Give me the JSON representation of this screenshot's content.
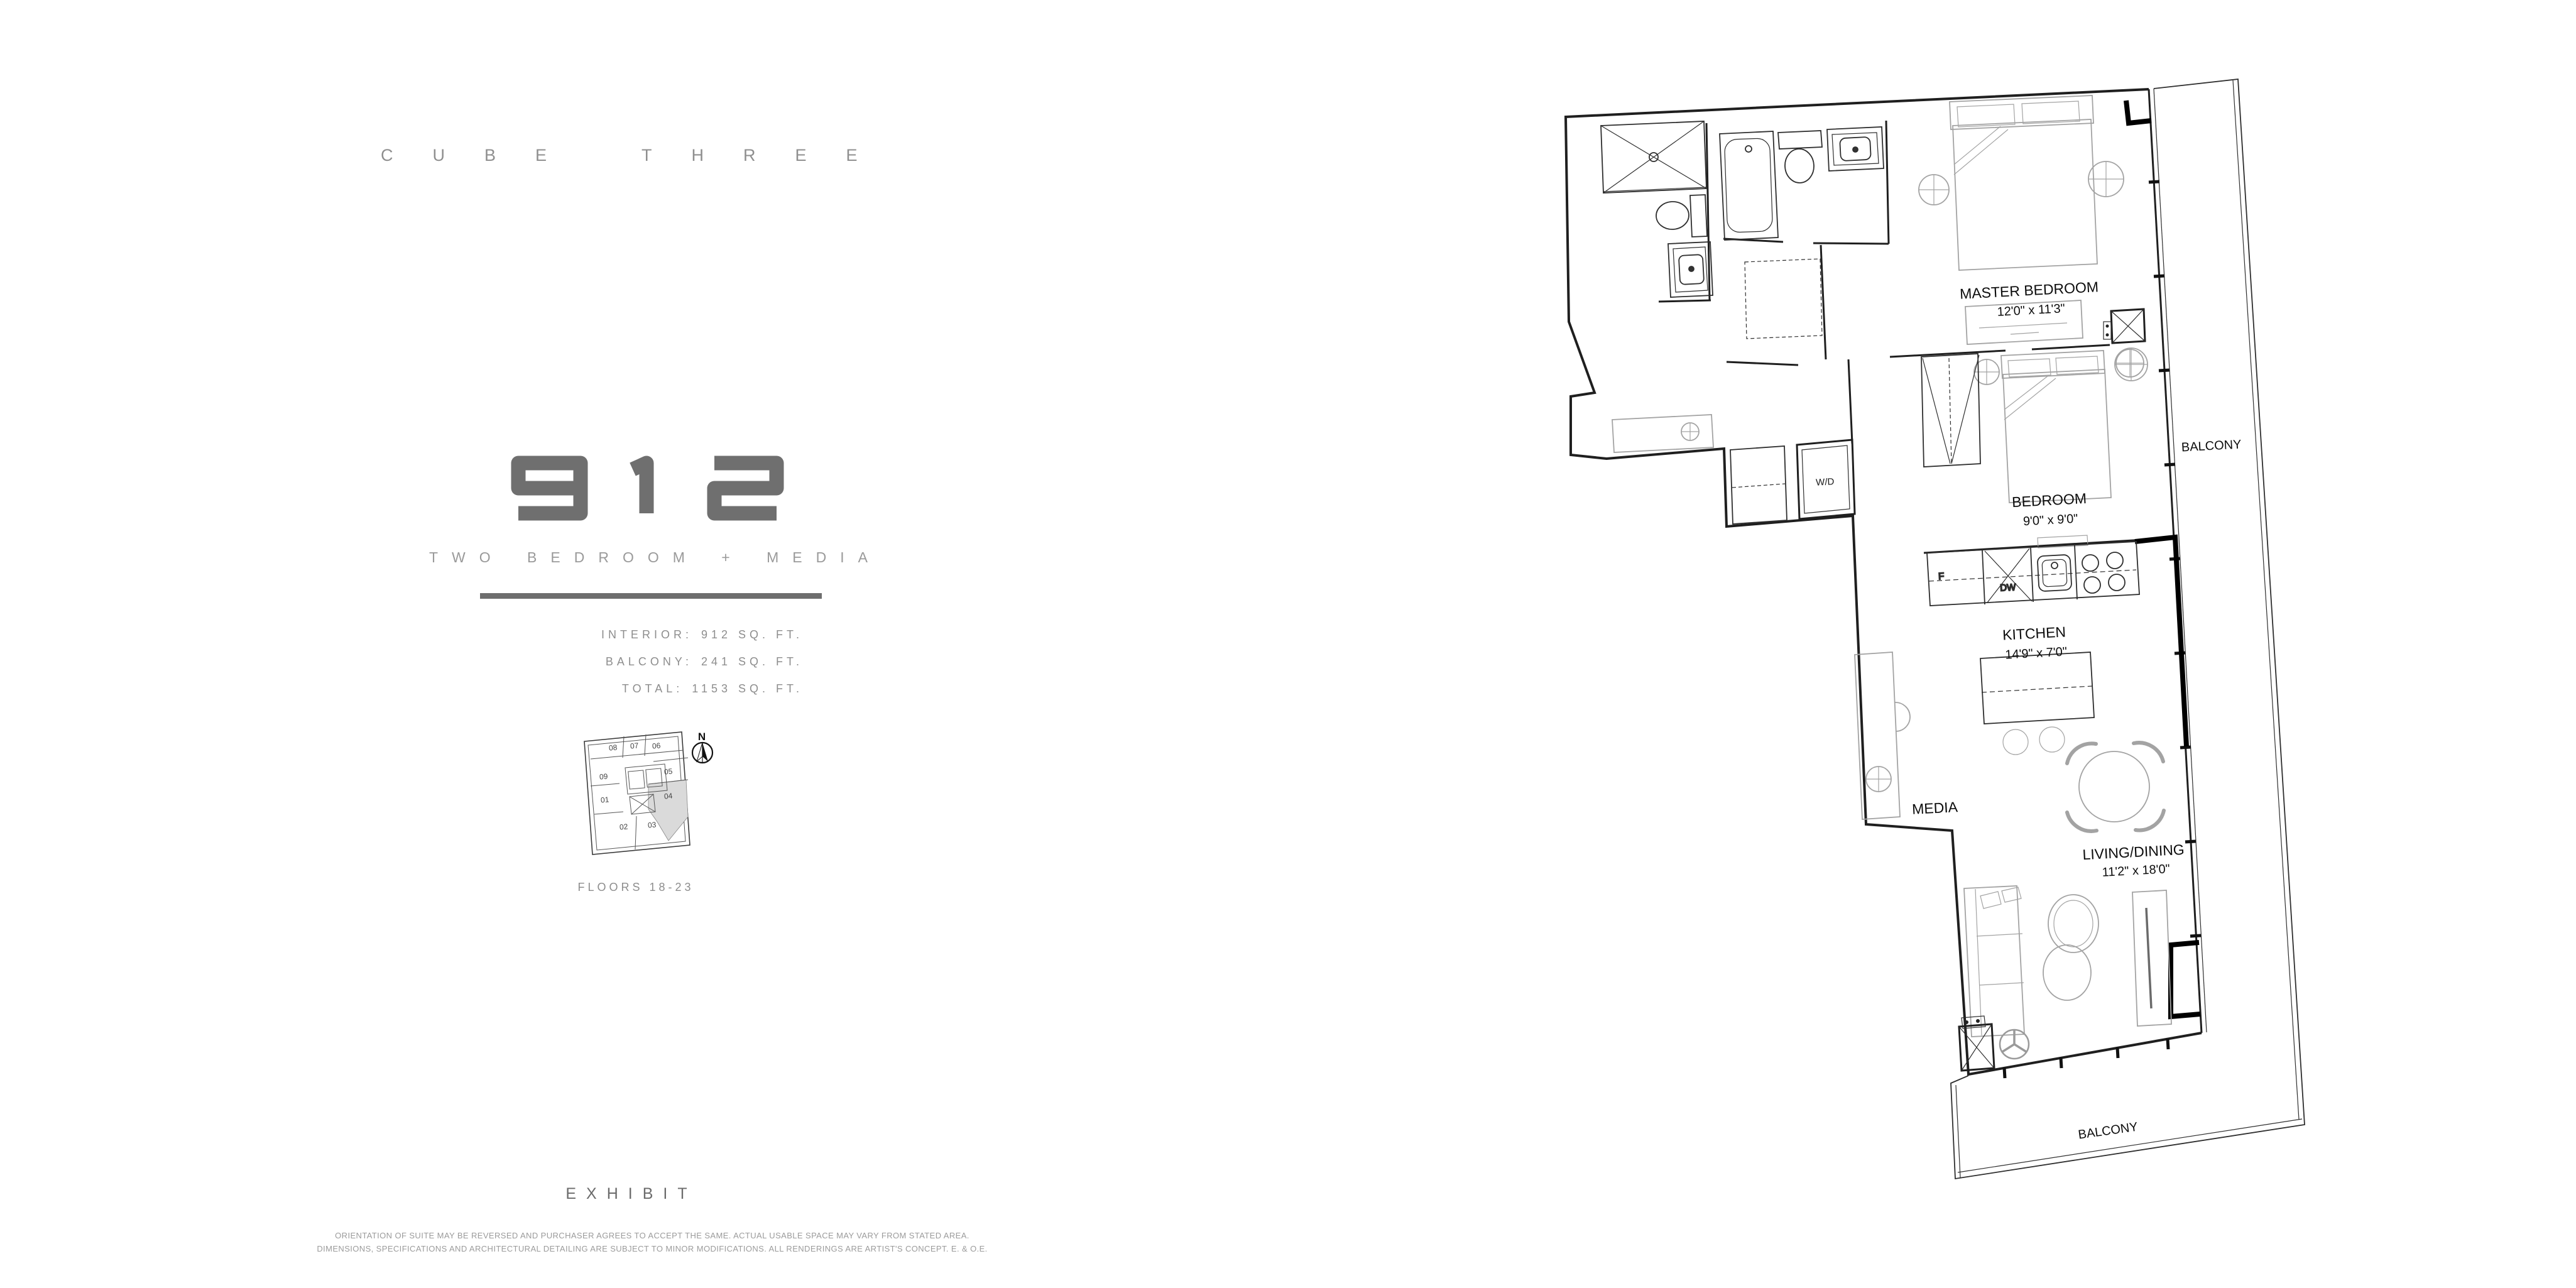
{
  "brand": {
    "name": "CUBE THREE"
  },
  "unit": {
    "number": "912",
    "type": "TWO BEDROOM + MEDIA"
  },
  "stats": {
    "rows": [
      {
        "label": "INTERIOR:",
        "value": "912 SQ. FT."
      },
      {
        "label": "BALCONY:",
        "value": "241 SQ. FT."
      },
      {
        "label": "TOTAL:",
        "value": "1153 SQ. FT."
      }
    ]
  },
  "keyplan": {
    "floors_label": "FLOORS 18-23",
    "north_label": "N",
    "highlighted_unit": "04",
    "units": [
      {
        "id": "08"
      },
      {
        "id": "07"
      },
      {
        "id": "06"
      },
      {
        "id": "09"
      },
      {
        "id": "05"
      },
      {
        "id": "01"
      },
      {
        "id": "04"
      },
      {
        "id": "02"
      },
      {
        "id": "03"
      }
    ]
  },
  "floor_plan": {
    "rooms": {
      "master_bedroom": {
        "name": "MASTER BEDROOM",
        "dims": "12'0\" x 11'3\""
      },
      "bedroom": {
        "name": "BEDROOM",
        "dims": "9'0\" x 9'0\""
      },
      "kitchen": {
        "name": "KITCHEN",
        "dims": "14'9\" x 7'0\""
      },
      "living_dining": {
        "name": "LIVING/DINING",
        "dims": "11'2\" x 18'0\""
      }
    },
    "labels": {
      "media": "MEDIA",
      "balcony_right": "BALCONY",
      "balcony_bottom": "BALCONY",
      "washer_dryer": "W/D",
      "fridge": "F",
      "dishwasher": "DW"
    }
  },
  "footer": {
    "exhibit": "EXHIBIT",
    "disclaimer_line1": "ORIENTATION OF SUITE MAY BE REVERSED AND PURCHASER AGREES TO ACCEPT THE SAME.  ACTUAL USABLE SPACE MAY VARY FROM STATED AREA.",
    "disclaimer_line2": "DIMENSIONS, SPECIFICATIONS AND ARCHITECTURAL DETAILING ARE SUBJECT TO MINOR MODIFICATIONS. ALL RENDERINGS ARE ARTIST'S CONCEPT. E. & O.E."
  },
  "colors": {
    "line": "#1f1f1f",
    "furniture_gray": "#a3a3a3",
    "muted_text": "#8d8d8d",
    "accent_text": "#6f6f6f",
    "highlight_fill": "#dadada"
  }
}
